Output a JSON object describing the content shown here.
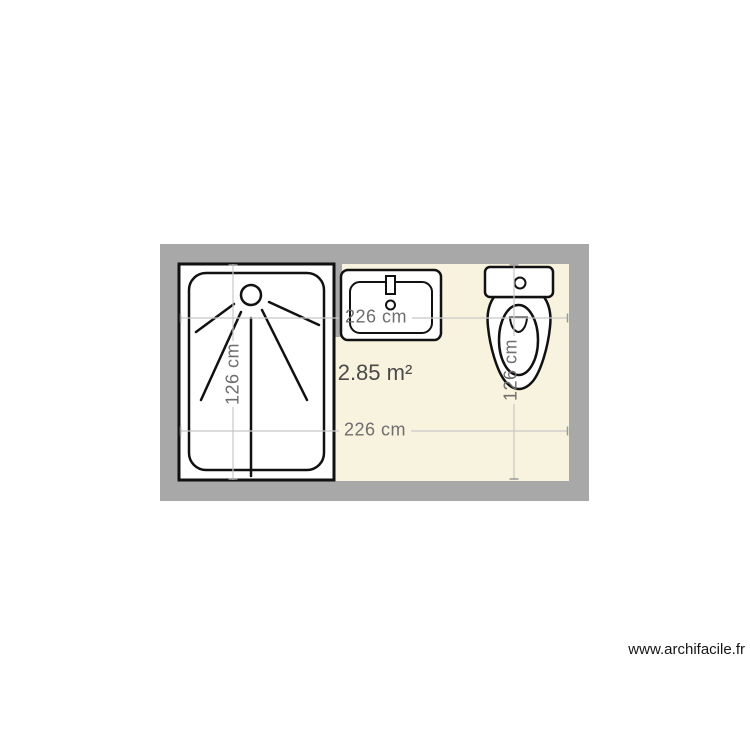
{
  "plan": {
    "area_label": "2.85 m²",
    "dimension_labels": {
      "top": "226 cm",
      "bottom": "226 cm",
      "left": "126 cm",
      "right": "126 cm"
    },
    "fixtures": [
      {
        "name": "shower"
      },
      {
        "name": "washbasin"
      },
      {
        "name": "toilet"
      }
    ],
    "colors": {
      "wall": "#a8a8a8",
      "floor": "#f8f3de",
      "fixture_fill": "#ffffff",
      "outline": "#111111",
      "dimension_line": "#c7c7c7",
      "dimension_tick": "#999999",
      "dimension_text": "#6e6e6e",
      "area_text": "#4a4a4a"
    }
  },
  "watermark": {
    "text": "www.archifacile.fr"
  }
}
